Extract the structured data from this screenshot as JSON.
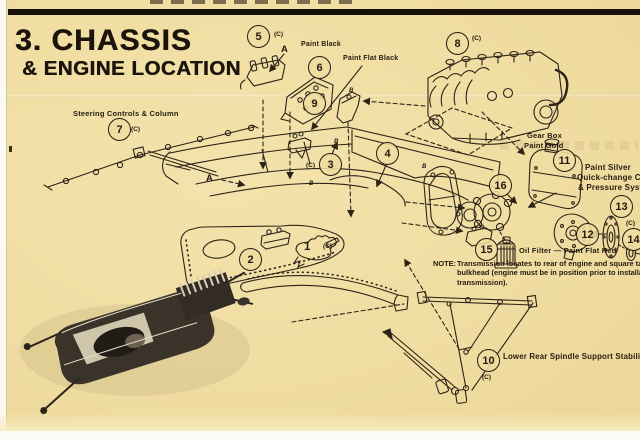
{
  "sheet": {
    "step_title_line1": "3. CHASSIS",
    "step_title_line2": "& ENGINE LOCATION",
    "labels": {
      "steering": "Steering Controls & Column",
      "paint_black": "Paint Black",
      "paint_flat_black": "Paint Flat Black",
      "gear_box_line1": "Gear Box",
      "gear_box_line2": "Paint Gold",
      "paint_silver_line1": "Paint Silver",
      "paint_silver_line2": "Quick-change Cover",
      "paint_silver_line3": "& Pressure System",
      "oil_filter": "Oil Filter — Paint Flat Red",
      "stabilizer": "Lower Rear Spindle Support Stabilizer"
    },
    "note": {
      "prefix": "NOTE:",
      "body": "Transmission locates to rear of engine and square tab on rear bulkhead (engine must be in position prior to installation of transmission)."
    },
    "markers": {
      "a": "A",
      "b": "B",
      "c_suffix": "(C)"
    },
    "callouts": {
      "c1": "1",
      "c2": "2",
      "c3": "3",
      "c4": "4",
      "c5": "5",
      "c6": "6",
      "c7": "7",
      "c8": "8",
      "c9": "9",
      "c10": "10",
      "c11": "11",
      "c12": "12",
      "c13": "13",
      "c14": "14",
      "c15": "15",
      "c16": "16"
    },
    "colors": {
      "paper": "#f0dca0",
      "ink": "#241c10"
    }
  }
}
